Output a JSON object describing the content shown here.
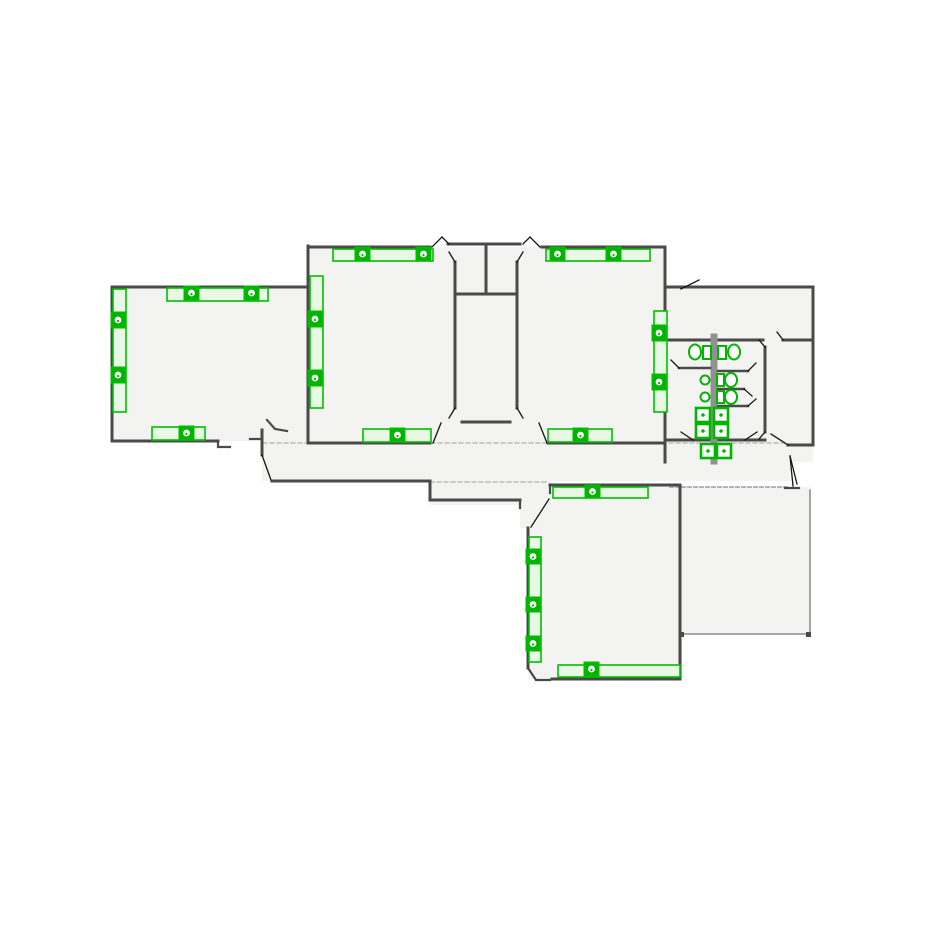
{
  "background": "#ffffff",
  "colors": {
    "wall": "#4a4a4a",
    "door": "#141414",
    "plumbing": "#919191",
    "floor": "#f3f3f1",
    "patio_edge": "#8a8a8a",
    "dash": "#b3b3b3",
    "fixture_border": "#00c000",
    "fixture_fill": "#e9f8e4",
    "symbol_green": "#00b400",
    "white": "#ffffff"
  },
  "plan": {
    "canvas": {
      "width": 925,
      "height": 925
    },
    "floors": [
      [
        112,
        287,
        196,
        154
      ],
      [
        308,
        247,
        357,
        196
      ],
      [
        665,
        287,
        148,
        175
      ],
      [
        262,
        425,
        528,
        56
      ],
      [
        430,
        481,
        120,
        24
      ],
      [
        520,
        481,
        32,
        47
      ],
      [
        528,
        485,
        154,
        194
      ],
      [
        682,
        487,
        128,
        147
      ]
    ],
    "dashed_lines": [
      {
        "pts": [
          [
            263,
            443
          ],
          [
            788,
            443
          ]
        ],
        "w": 1.3,
        "dash": "4 3"
      },
      {
        "pts": [
          [
            430,
            482
          ],
          [
            548,
            482
          ]
        ],
        "w": 1.3,
        "dash": "4 3"
      },
      {
        "pts": [
          [
            670,
            487
          ],
          [
            788,
            487
          ]
        ],
        "w": 2,
        "dash": "3 3"
      }
    ],
    "walls": [
      [
        [
          112,
          287
        ],
        [
          308,
          287
        ]
      ],
      [
        [
          112,
          287
        ],
        [
          112,
          441
        ]
      ],
      [
        [
          112,
          441
        ],
        [
          218,
          441
        ]
      ],
      [
        [
          308,
          246
        ],
        [
          308,
          443
        ]
      ],
      [
        [
          308,
          247
        ],
        [
          430,
          247
        ]
      ],
      [
        [
          308,
          443
        ],
        [
          430,
          443
        ]
      ],
      [
        [
          448,
          244
        ],
        [
          520,
          244
        ]
      ],
      [
        [
          486,
          244
        ],
        [
          486,
          294
        ]
      ],
      [
        [
          455,
          294
        ],
        [
          516,
          294
        ]
      ],
      [
        [
          455,
          262
        ],
        [
          455,
          408
        ]
      ],
      [
        [
          517,
          262
        ],
        [
          517,
          408
        ]
      ],
      [
        [
          462,
          422
        ],
        [
          510,
          422
        ]
      ],
      [
        [
          542,
          247
        ],
        [
          665,
          247
        ]
      ],
      [
        [
          548,
          443
        ],
        [
          665,
          443
        ]
      ],
      [
        [
          665,
          247
        ],
        [
          665,
          462
        ]
      ],
      [
        [
          665,
          287
        ],
        [
          813,
          287
        ]
      ],
      [
        [
          813,
          287
        ],
        [
          813,
          445
        ]
      ],
      [
        [
          665,
          340
        ],
        [
          763,
          340
        ]
      ],
      [
        [
          783,
          340
        ],
        [
          813,
          340
        ]
      ],
      [
        [
          665,
          440
        ],
        [
          765,
          440
        ]
      ],
      [
        [
          765,
          347
        ],
        [
          765,
          432
        ]
      ],
      [
        [
          788,
          445
        ],
        [
          813,
          445
        ]
      ],
      [
        [
          262,
          430
        ],
        [
          262,
          455
        ]
      ],
      [
        [
          272,
          481
        ],
        [
          430,
          481
        ]
      ],
      [
        [
          430,
          481
        ],
        [
          430,
          500
        ]
      ],
      [
        [
          430,
          500
        ],
        [
          520,
          500
        ]
      ],
      [
        [
          550,
          485
        ],
        [
          680,
          485
        ]
      ],
      [
        [
          680,
          485
        ],
        [
          680,
          679
        ]
      ],
      [
        [
          552,
          679
        ],
        [
          680,
          679
        ]
      ],
      [
        [
          528,
          528
        ],
        [
          528,
          668
        ]
      ]
    ],
    "jambs": [
      [
        [
          218,
          441
        ],
        [
          218,
          447
        ],
        [
          230,
          447
        ]
      ],
      [
        [
          267,
          420
        ],
        [
          275,
          429
        ],
        [
          287,
          431
        ]
      ],
      [
        [
          250,
          439
        ],
        [
          262,
          439
        ]
      ],
      [
        [
          520,
          500
        ],
        [
          520,
          508
        ]
      ],
      [
        [
          528,
          668
        ],
        [
          536,
          680
        ],
        [
          550,
          680
        ]
      ],
      [
        [
          550,
          485
        ],
        [
          550,
          493
        ]
      ],
      [
        [
          785,
          488
        ],
        [
          799,
          488
        ]
      ]
    ],
    "plumbing_wall": [
      [
        714,
        337
      ],
      [
        714,
        461
      ]
    ],
    "partitions": [
      [
        [
          679,
          368
        ],
        [
          710,
          368
        ]
      ],
      [
        [
          718,
          371
        ],
        [
          748,
          371
        ]
      ],
      [
        [
          718,
          389
        ],
        [
          744,
          389
        ]
      ],
      [
        [
          718,
          406
        ],
        [
          748,
          406
        ]
      ]
    ],
    "patio_edges": [
      [
        [
          810,
          490
        ],
        [
          810,
          634
        ]
      ],
      [
        [
          682,
          634
        ],
        [
          810,
          634
        ]
      ]
    ],
    "door_leaves": [
      [
        [
          432,
          247
        ],
        [
          442,
          237
        ]
      ],
      [
        [
          442,
          237
        ],
        [
          449,
          244
        ]
      ],
      [
        [
          540,
          247
        ],
        [
          530,
          237
        ]
      ],
      [
        [
          530,
          237
        ],
        [
          523,
          244
        ]
      ],
      [
        [
          455,
          262
        ],
        [
          449,
          252
        ]
      ],
      [
        [
          517,
          262
        ],
        [
          523,
          252
        ]
      ],
      [
        [
          455,
          408
        ],
        [
          449,
          418
        ]
      ],
      [
        [
          517,
          408
        ],
        [
          523,
          418
        ]
      ],
      [
        [
          433,
          443
        ],
        [
          441,
          423
        ]
      ],
      [
        [
          547,
          443
        ],
        [
          539,
          423
        ]
      ],
      [
        [
          262,
          455
        ],
        [
          271,
          480
        ]
      ],
      [
        [
          790,
          456
        ],
        [
          793,
          486
        ]
      ],
      [
        [
          790,
          456
        ],
        [
          797,
          484
        ]
      ],
      [
        [
          681,
          289
        ],
        [
          699,
          280
        ]
      ],
      [
        [
          777,
          332
        ],
        [
          783,
          340
        ]
      ],
      [
        [
          681,
          432
        ],
        [
          693,
          440
        ]
      ],
      [
        [
          757,
          432
        ],
        [
          745,
          440
        ]
      ],
      [
        [
          759,
          340
        ],
        [
          765,
          347
        ]
      ],
      [
        [
          759,
          439
        ],
        [
          765,
          432
        ]
      ],
      [
        [
          788,
          445
        ],
        [
          771,
          434
        ]
      ],
      [
        [
          549,
          499
        ],
        [
          531,
          527
        ]
      ],
      [
        [
          679,
          368
        ],
        [
          671,
          360
        ]
      ],
      [
        [
          748,
          371
        ],
        [
          756,
          363
        ]
      ],
      [
        [
          744,
          389
        ],
        [
          752,
          396
        ]
      ],
      [
        [
          748,
          406
        ],
        [
          756,
          399
        ]
      ]
    ],
    "fixture_strips": [
      [
        167,
        288,
        101,
        13
      ],
      [
        113,
        289,
        13,
        123
      ],
      [
        152,
        427,
        53,
        13
      ],
      [
        333,
        249,
        100,
        12
      ],
      [
        310,
        276,
        13,
        132
      ],
      [
        363,
        429,
        68,
        13
      ],
      [
        546,
        249,
        104,
        12
      ],
      [
        654,
        311,
        13,
        101
      ],
      [
        548,
        429,
        64,
        13
      ],
      [
        553,
        487,
        95,
        11
      ],
      [
        529,
        537,
        12,
        125
      ],
      [
        558,
        665,
        122,
        12
      ]
    ],
    "fixture_symbols": [
      [
        184,
        286,
        15,
        14
      ],
      [
        244,
        286,
        15,
        14
      ],
      [
        111,
        312,
        14,
        16
      ],
      [
        111,
        367,
        14,
        16
      ],
      [
        179,
        426,
        15,
        14
      ],
      [
        355,
        247,
        15,
        14
      ],
      [
        416,
        247,
        15,
        14
      ],
      [
        308,
        311,
        14,
        16
      ],
      [
        308,
        370,
        14,
        16
      ],
      [
        390,
        428,
        15,
        14
      ],
      [
        550,
        247,
        15,
        14
      ],
      [
        606,
        247,
        15,
        14
      ],
      [
        652,
        325,
        14,
        16
      ],
      [
        652,
        374,
        14,
        16
      ],
      [
        573,
        428,
        15,
        14
      ],
      [
        585,
        485,
        15,
        13
      ],
      [
        526,
        549,
        14,
        15
      ],
      [
        526,
        597,
        14,
        15
      ],
      [
        526,
        636,
        14,
        15
      ],
      [
        584,
        662,
        15,
        14
      ]
    ],
    "toilets": [
      {
        "tank": [
          703,
          346,
          8,
          13
        ],
        "bowl": [
          695,
          352,
          6,
          7.5
        ]
      },
      {
        "tank": [
          718,
          346,
          8,
          13
        ],
        "bowl": [
          734,
          352,
          6,
          7.5
        ]
      },
      {
        "tank": [
          717,
          374,
          7,
          12
        ],
        "bowl": [
          731,
          380,
          6,
          7
        ]
      },
      {
        "tank": [
          717,
          391,
          7,
          12
        ],
        "bowl": [
          731,
          397,
          6,
          7
        ]
      }
    ],
    "wall_fittings": [
      [
        705,
        380,
        4.5
      ],
      [
        705,
        397,
        4.5
      ]
    ],
    "sinks": [
      [
        696,
        408,
        14
      ],
      [
        714,
        408,
        14
      ],
      [
        696,
        424,
        14
      ],
      [
        714,
        424,
        14
      ],
      [
        701,
        444,
        14
      ],
      [
        717,
        444,
        14
      ]
    ],
    "corner_dots": [
      [
        679,
        632,
        5
      ],
      [
        806,
        632,
        5
      ]
    ]
  }
}
